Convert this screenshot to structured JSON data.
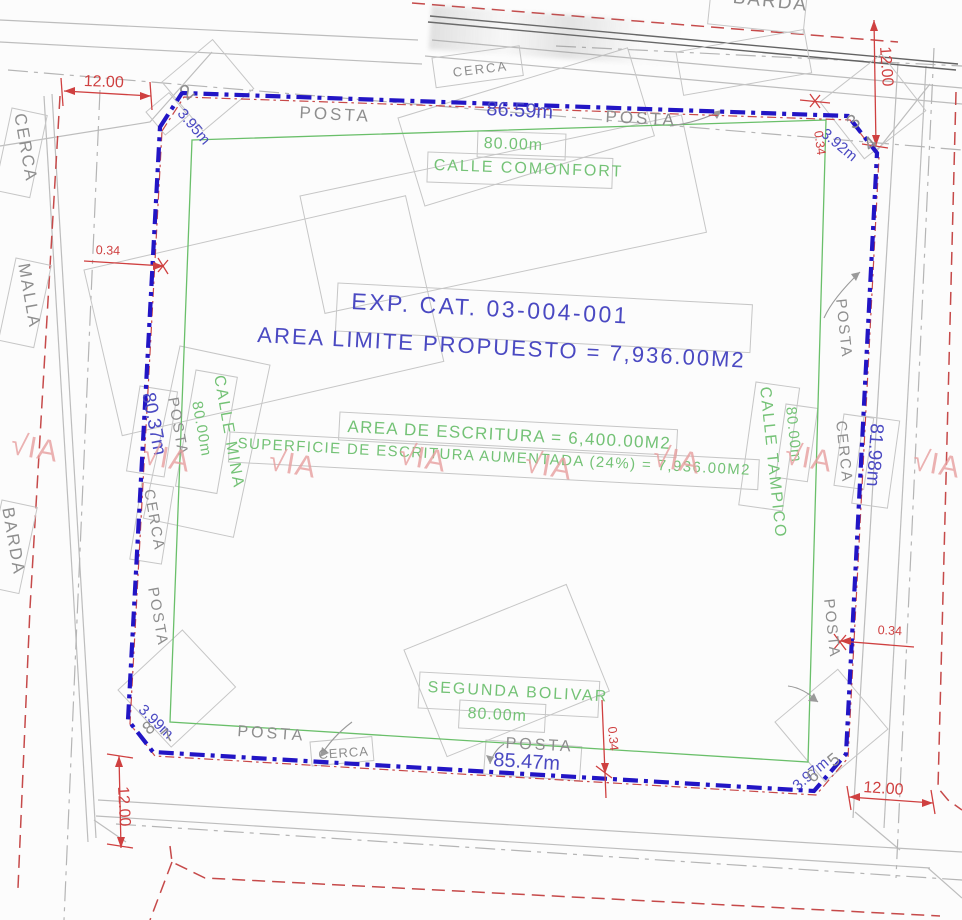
{
  "drawing": {
    "exp_cat": "EXP. CAT. 03-004-001",
    "area_limite": "AREA LIMITE PROPUESTO = 7,936.00M2",
    "area_escritura": "AREA DE ESCRITURA = 6,400.00M2",
    "superficie_aumentada": "SUPERFICIE DE ESCRITURA AUMENTADA (24%) = 7,936.00M2"
  },
  "streets": {
    "north": {
      "name": "CALLE COMONFORT",
      "width_label": "80.00m"
    },
    "south": {
      "name": "SEGUNDA BOLIVAR",
      "width_label": "80.00m"
    },
    "west": {
      "name": "CALLE MINA",
      "width_label": "80.00m"
    },
    "east": {
      "name": "CALLE TAMPICO",
      "width_label": "80.00m"
    }
  },
  "boundary_lengths": {
    "north": "86.59m",
    "south": "85.47m",
    "west": "80.37m",
    "east": "81.98m"
  },
  "chamfers": {
    "nw": "3.95m",
    "ne": "3.92m",
    "se": "3.97m",
    "sw": "3.99m"
  },
  "vertices": {
    "v2": "2",
    "v3": "3",
    "v4": "4",
    "v5": "5",
    "v6": "6",
    "v7": "7",
    "v8": "8"
  },
  "dimensions": {
    "street_width": "12.00",
    "fence_offset": "0.34"
  },
  "fences": {
    "posta": "POSTA",
    "cerca": "CERCA",
    "malla": "MALLA",
    "barda": "BARDA"
  },
  "watermark": {
    "text": "√IA"
  },
  "colors": {
    "boundary_blue": "#2215c5",
    "text_blue": "#4a49c2",
    "parcel_green": "#6abf6a",
    "text_green": "#74c276",
    "dimension_red": "#cf4040",
    "street_red_dashed": "#c64a4a",
    "cad_gray_text": "#8e8e8e",
    "cad_gray_line": "#bdbdbd",
    "barda_dark_gray": "#636363",
    "watermark_pink": "#e79f9f"
  }
}
